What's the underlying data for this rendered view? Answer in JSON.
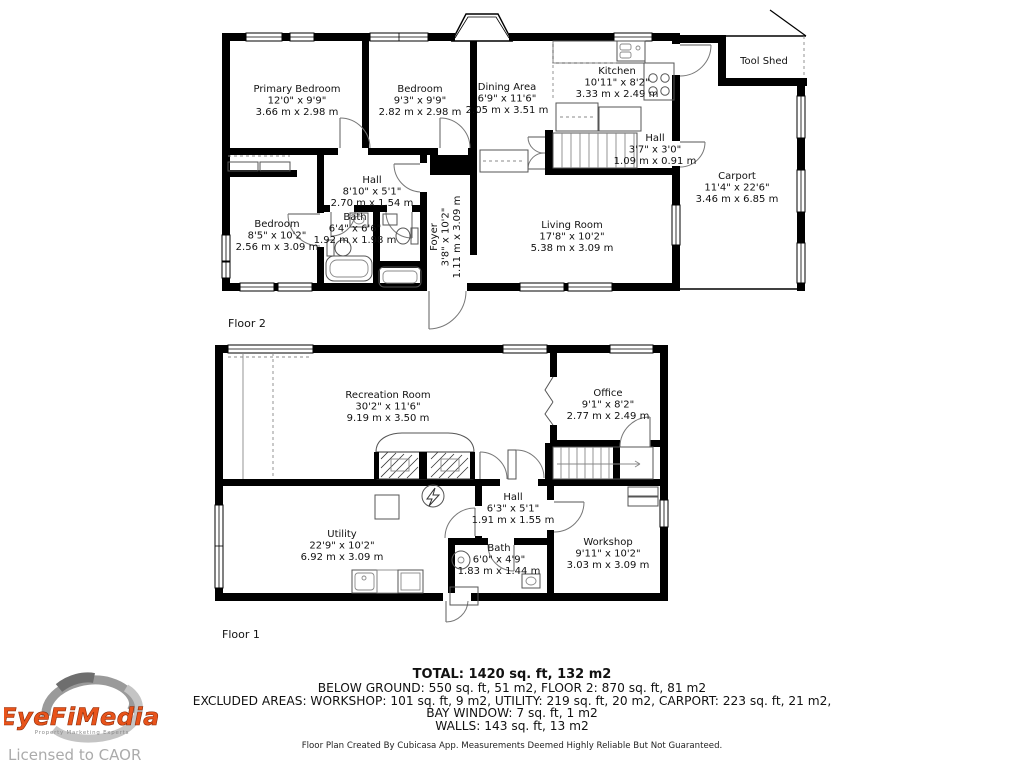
{
  "floor2": {
    "label": "Floor 2",
    "rooms": {
      "primary": {
        "name": "Primary Bedroom",
        "imperial": "12'0\" x 9'9\"",
        "metric": "3.66 m x 2.98 m"
      },
      "bedroom_top": {
        "name": "Bedroom",
        "imperial": "9'3\" x 9'9\"",
        "metric": "2.82 m x 2.98 m"
      },
      "dining": {
        "name": "Dining Area",
        "imperial": "6'9\" x 11'6\"",
        "metric": "2.05 m x 3.51 m"
      },
      "kitchen": {
        "name": "Kitchen",
        "imperial": "10'11\" x 8'2\"",
        "metric": "3.33 m x 2.49 m"
      },
      "tool_shed": {
        "name": "Tool Shed"
      },
      "hall_small": {
        "name": "Hall",
        "imperial": "3'7\" x 3'0\"",
        "metric": "1.09 m x 0.91 m"
      },
      "carport": {
        "name": "Carport",
        "imperial": "11'4\" x 22'6\"",
        "metric": "3.46 m x 6.85 m"
      },
      "hall_main": {
        "name": "Hall",
        "imperial": "8'10\" x 5'1\"",
        "metric": "2.70 m x 1.54 m"
      },
      "bedroom_low": {
        "name": "Bedroom",
        "imperial": "8'5\" x 10'2\"",
        "metric": "2.56 m x 3.09 m"
      },
      "bath": {
        "name": "Bath",
        "imperial": "6'4\" x 6'6\"",
        "metric": "1.92 m x 1.98 m"
      },
      "foyer": {
        "name": "Foyer",
        "imperial": "3'8\" x 10'2\"",
        "metric": "1.11 m x 3.09 m"
      },
      "living": {
        "name": "Living Room",
        "imperial": "17'8\" x 10'2\"",
        "metric": "5.38 m x 3.09 m"
      }
    }
  },
  "floor1": {
    "label": "Floor 1",
    "rooms": {
      "recreation": {
        "name": "Recreation Room",
        "imperial": "30'2\" x 11'6\"",
        "metric": "9.19 m x 3.50 m"
      },
      "office": {
        "name": "Office",
        "imperial": "9'1\" x 8'2\"",
        "metric": "2.77 m x 2.49 m"
      },
      "hall": {
        "name": "Hall",
        "imperial": "6'3\" x 5'1\"",
        "metric": "1.91 m x 1.55 m"
      },
      "utility": {
        "name": "Utility",
        "imperial": "22'9\" x 10'2\"",
        "metric": "6.92 m x 3.09 m"
      },
      "bath": {
        "name": "Bath",
        "imperial": "6'0\" x 4'9\"",
        "metric": "1.83 m x 1.44 m"
      },
      "workshop": {
        "name": "Workshop",
        "imperial": "9'11\" x 10'2\"",
        "metric": "3.03 m x 3.09 m"
      }
    }
  },
  "summary": {
    "total": "TOTAL: 1420 sq. ft, 132 m2",
    "line2": "BELOW GROUND: 550 sq. ft, 51 m2, FLOOR 2: 870 sq. ft, 81 m2",
    "line3": "EXCLUDED AREAS: WORKSHOP: 101 sq. ft, 9 m2, UTILITY: 219 sq. ft, 20 m2, CARPORT: 223 sq. ft, 21 m2,",
    "line4": "BAY WINDOW: 7 sq. ft, 1 m2",
    "line5": "WALLS: 143 sq. ft, 13 m2",
    "disclaimer": "Floor Plan Created By Cubicasa App. Measurements Deemed Highly Reliable But Not Guaranteed."
  },
  "branding": {
    "logo_text": "EyeFiMedia",
    "tagline": "Property Marketing Experts",
    "license": "Licensed to CAOR",
    "logo_color": "#e8531a",
    "gray": "#ababab"
  }
}
